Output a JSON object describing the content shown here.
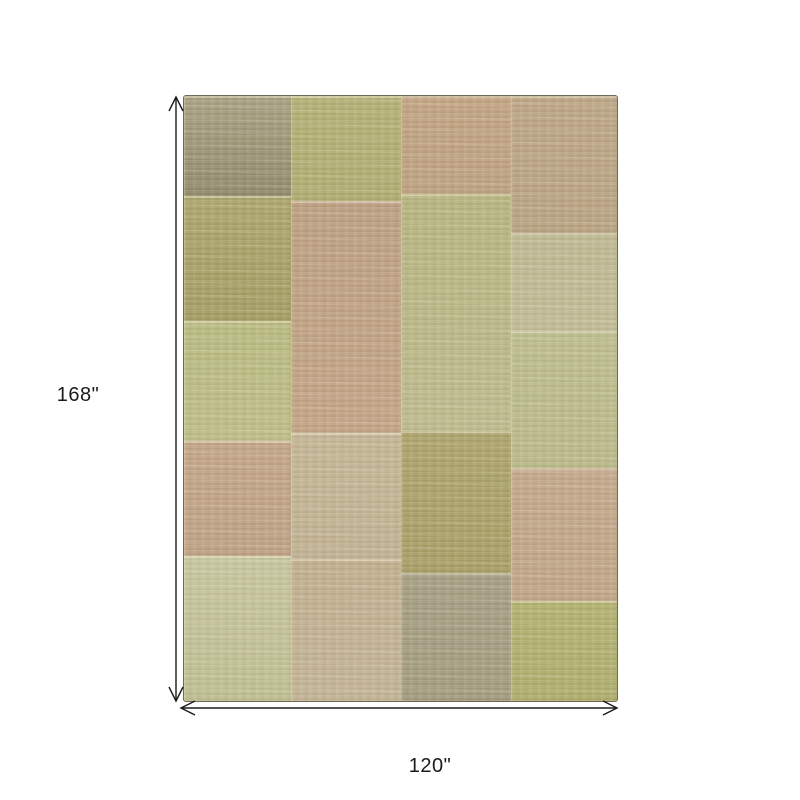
{
  "figure": {
    "type": "product-dimension-diagram",
    "subject": "patchwork-area-rug",
    "background_color": "#ffffff",
    "arrow_color": "#1b1b1b"
  },
  "dimensions": {
    "height_label": "168\"",
    "width_label": "120\""
  },
  "rug": {
    "x": 183,
    "y": 95,
    "width": 433,
    "height": 605,
    "border_color": "#6e6856",
    "palette_description": "muted sage green, olive, khaki, tan and dusty blush patches",
    "columns": [
      {
        "x": 0,
        "width": 107,
        "patches": [
          {
            "y": 0,
            "height": 100,
            "color": "#a79f80",
            "color2": "#90886a"
          },
          {
            "y": 100,
            "height": 125,
            "color": "#aba36b",
            "color2": "#a39b62"
          },
          {
            "y": 225,
            "height": 120,
            "color": "#b7b97f",
            "color2": "#bcbd86"
          },
          {
            "y": 345,
            "height": 115,
            "color": "#c2a487",
            "color2": "#bda083"
          },
          {
            "y": 460,
            "height": 145,
            "color": "#c6c59e",
            "color2": "#bdbd90"
          }
        ]
      },
      {
        "x": 107,
        "width": 110,
        "patches": [
          {
            "y": 0,
            "height": 105,
            "color": "#b2af74",
            "color2": "#aeab70"
          },
          {
            "y": 105,
            "height": 232,
            "color": "#bb9e81",
            "color2": "#c2a385"
          },
          {
            "y": 337,
            "height": 126,
            "color": "#c3b494",
            "color2": "#c0b091"
          },
          {
            "y": 463,
            "height": 142,
            "color": "#bfae8e",
            "color2": "#c2b295"
          }
        ]
      },
      {
        "x": 217,
        "width": 110,
        "patches": [
          {
            "y": 0,
            "height": 98,
            "color": "#c0a282",
            "color2": "#bca07f"
          },
          {
            "y": 98,
            "height": 237,
            "color": "#b4b37e",
            "color2": "#bcba8c"
          },
          {
            "y": 335,
            "height": 142,
            "color": "#aba26b",
            "color2": "#a69d64"
          },
          {
            "y": 477,
            "height": 128,
            "color": "#a49d82",
            "color2": "#a19a7e"
          }
        ]
      },
      {
        "x": 327,
        "width": 106,
        "patches": [
          {
            "y": 0,
            "height": 137,
            "color": "#bba485",
            "color2": "#b7a181"
          },
          {
            "y": 137,
            "height": 98,
            "color": "#bdb791",
            "color2": "#c0ba95"
          },
          {
            "y": 235,
            "height": 137,
            "color": "#bcbc8d",
            "color2": "#b8b887"
          },
          {
            "y": 372,
            "height": 133,
            "color": "#c2a78a",
            "color2": "#bfa486"
          },
          {
            "y": 505,
            "height": 100,
            "color": "#b1b06f",
            "color2": "#adac6b"
          }
        ]
      }
    ]
  }
}
